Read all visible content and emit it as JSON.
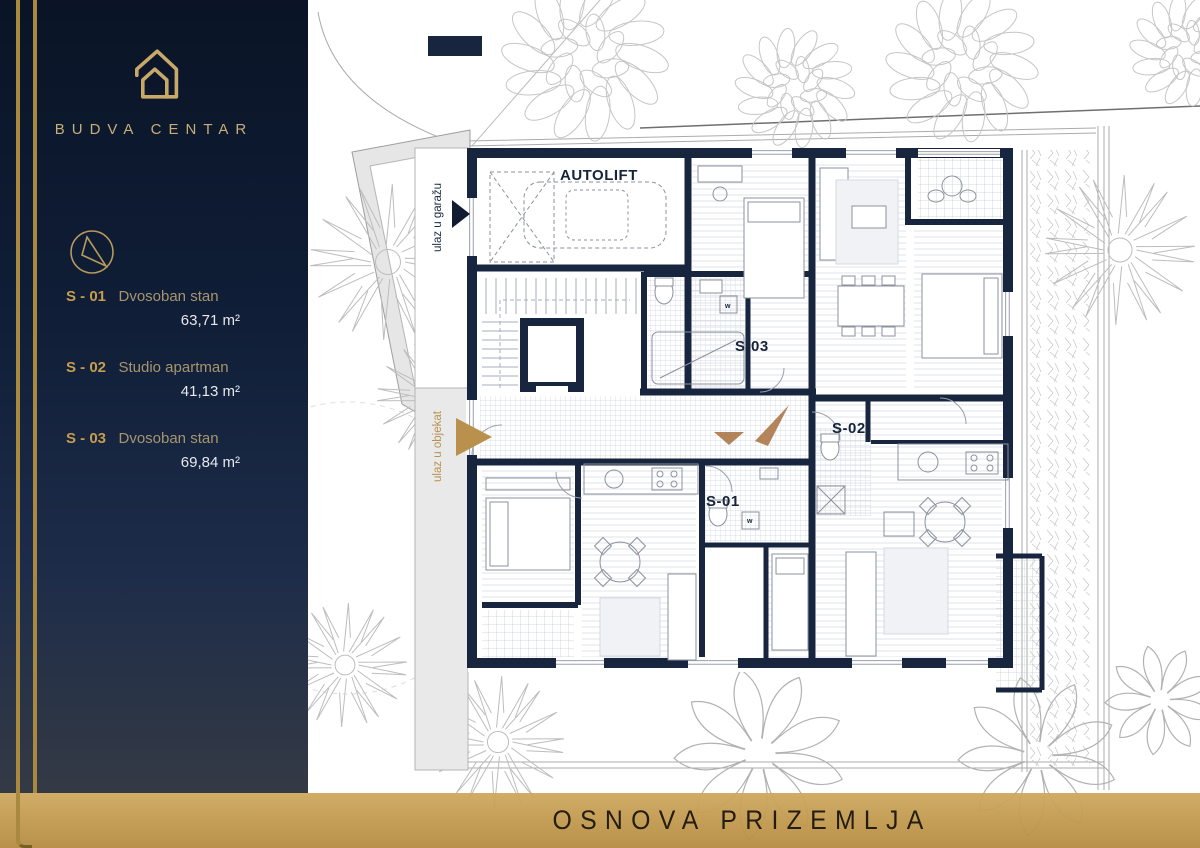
{
  "brand": {
    "name": "BUDVA CENTAR"
  },
  "sidebar": {
    "units": [
      {
        "id": "S - 01",
        "type": "Dvosoban stan",
        "area": "63,71 m²"
      },
      {
        "id": "S - 02",
        "type": "Studio apartman",
        "area": "41,13 m²"
      },
      {
        "id": "S - 03",
        "type": "Dvosoban stan",
        "area": "69,84 m²"
      }
    ]
  },
  "footer": {
    "title": "OSNOVA PRIZEMLJA"
  },
  "plan": {
    "labels": {
      "autolift": "AUTOLIFT",
      "s01": "S-01",
      "s02": "S-02",
      "s03": "S-03",
      "garage_entrance": "ulaz u garažu",
      "building_entrance": "ulaz u objekat",
      "washer": "w"
    },
    "colors": {
      "wall": "#18253F",
      "gold": "#A9883F",
      "gold_bar": "#C49C51",
      "entrance_arrow": "#A8703E",
      "navy_background": "#0C1830",
      "tree_line": "#BDBDBD"
    }
  }
}
